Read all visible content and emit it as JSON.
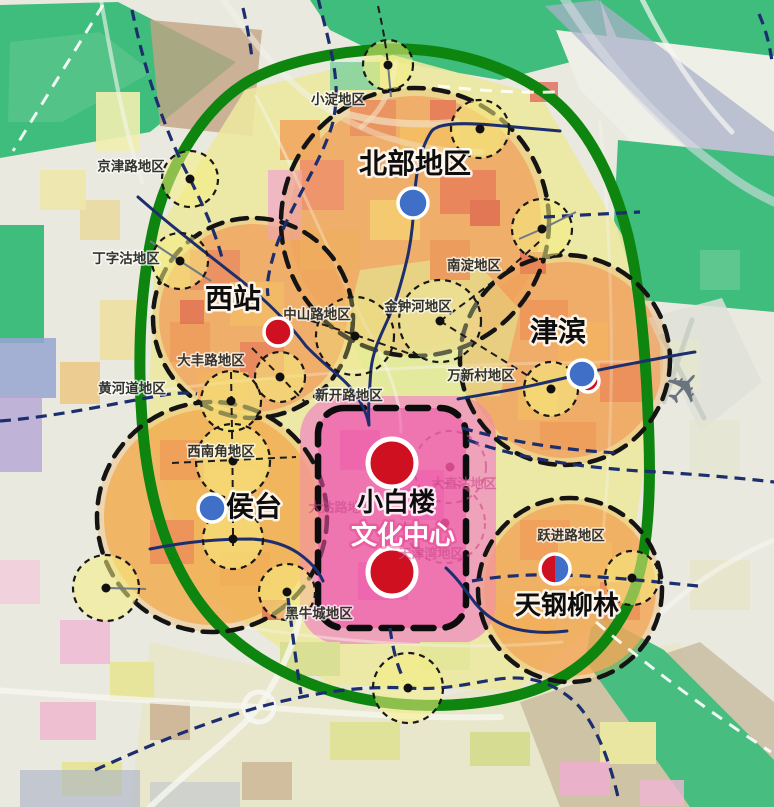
{
  "map": {
    "colors": {
      "ring_green": "#0e850f",
      "corridor_green": "#3fbd7c",
      "navy_line": "#1d2e6e",
      "node_blue": "#3f6fc7",
      "node_red": "#cf1020",
      "center_pink": "#ee55a8",
      "subcenter_yellow": "rgba(246,238,130,0.55)"
    },
    "regions": [
      {
        "id": "beibu",
        "text": "北部地区",
        "x": 415,
        "y": 173,
        "size": 28
      },
      {
        "id": "xizhan",
        "text": "西站",
        "x": 233,
        "y": 308,
        "size": 28
      },
      {
        "id": "jinbin",
        "text": "津滨",
        "x": 558,
        "y": 341,
        "size": 28
      },
      {
        "id": "houtai",
        "text": "侯台",
        "x": 254,
        "y": 516,
        "size": 28
      },
      {
        "id": "xiaobailou",
        "text": "小白楼",
        "x": 396,
        "y": 511,
        "size": 26
      },
      {
        "id": "wenhuazhongxin",
        "text": "文化中心",
        "x": 403,
        "y": 544,
        "size": 26,
        "color": "#ffffff",
        "halo": "rgba(230,60,140,0.45)"
      },
      {
        "id": "tiangangliulin",
        "text": "天钢柳林",
        "x": 567,
        "y": 614,
        "size": 26
      }
    ],
    "areas": [
      {
        "id": "xiaodian",
        "text": "小淀地区",
        "x": 338,
        "y": 104
      },
      {
        "id": "jingjinlu",
        "text": "京津路地区",
        "x": 131,
        "y": 171
      },
      {
        "id": "dingzigu",
        "text": "丁字沽地区",
        "x": 126,
        "y": 263
      },
      {
        "id": "zhongshanlu",
        "text": "中山路地区",
        "x": 317,
        "y": 319
      },
      {
        "id": "jinzhonghe",
        "text": "金钟河地区",
        "x": 418,
        "y": 311
      },
      {
        "id": "nandian",
        "text": "南淀地区",
        "x": 474,
        "y": 270
      },
      {
        "id": "wanxincun",
        "text": "万新村地区",
        "x": 481,
        "y": 380
      },
      {
        "id": "xinkailu",
        "text": "新开路地区",
        "x": 349,
        "y": 400
      },
      {
        "id": "dafenglu",
        "text": "大丰路地区",
        "x": 211,
        "y": 365
      },
      {
        "id": "huanghedao",
        "text": "黄河道地区",
        "x": 132,
        "y": 393
      },
      {
        "id": "xinanjiao",
        "text": "西南角地区",
        "x": 221,
        "y": 456
      },
      {
        "id": "yuejinlu",
        "text": "跃进路地区",
        "x": 571,
        "y": 540
      },
      {
        "id": "heiniucheng",
        "text": "黑牛城地区",
        "x": 319,
        "y": 618
      }
    ],
    "faint_areas": [
      {
        "id": "dagulu",
        "text": "大沽路地区",
        "x": 341,
        "y": 512
      },
      {
        "id": "dazhigu",
        "text": "大直沽地区",
        "x": 464,
        "y": 488
      },
      {
        "id": "tianjinwan",
        "text": "天津湾地区",
        "x": 431,
        "y": 558
      }
    ],
    "districts": [
      {
        "id": "beibu",
        "cx": 415,
        "cy": 222,
        "r": 134,
        "tint": "rgba(240,165,85,0.30)"
      },
      {
        "id": "xizhan",
        "cx": 253,
        "cy": 318,
        "r": 100,
        "tint": "rgba(240,165,85,0.30)"
      },
      {
        "id": "jinbin",
        "cx": 565,
        "cy": 360,
        "r": 105,
        "tint": "rgba(240,160,80,0.32)"
      },
      {
        "id": "houtai",
        "cx": 212,
        "cy": 517,
        "r": 115,
        "tint": "rgba(243,170,75,0.32)"
      },
      {
        "id": "tiangang",
        "cx": 570,
        "cy": 590,
        "r": 92,
        "tint": "rgba(242,168,80,0.32)"
      }
    ],
    "center_district": {
      "id": "xiaobailou-wenhua",
      "x": 318,
      "y": 408,
      "w": 148,
      "h": 220,
      "rx": 26,
      "fill": "rgba(238,80,170,0.55)"
    },
    "subcenters": [
      {
        "cx": 388,
        "cy": 65,
        "r": 25
      },
      {
        "cx": 480,
        "cy": 129,
        "r": 29
      },
      {
        "cx": 190,
        "cy": 179,
        "r": 28
      },
      {
        "cx": 542,
        "cy": 229,
        "r": 30
      },
      {
        "cx": 180,
        "cy": 261,
        "r": 28
      },
      {
        "cx": 355,
        "cy": 336,
        "r": 39,
        "fill": "rgba(246,238,130,0.28)"
      },
      {
        "cx": 440,
        "cy": 321,
        "r": 41,
        "fill": "rgba(240,246,170,0.35)"
      },
      {
        "cx": 551,
        "cy": 389,
        "r": 27
      },
      {
        "cx": 280,
        "cy": 377,
        "r": 25
      },
      {
        "cx": 231,
        "cy": 401,
        "r": 30
      },
      {
        "cx": 233,
        "cy": 461,
        "r": 37
      },
      {
        "cx": 233,
        "cy": 539,
        "r": 30
      },
      {
        "cx": 106,
        "cy": 588,
        "r": 33
      },
      {
        "cx": 287,
        "cy": 592,
        "r": 28
      },
      {
        "cx": 408,
        "cy": 688,
        "r": 35
      },
      {
        "cx": 632,
        "cy": 578,
        "r": 27
      }
    ],
    "faint_subcenters": [
      {
        "cx": 450,
        "cy": 467,
        "r": 36
      },
      {
        "cx": 445,
        "cy": 523,
        "r": 40
      }
    ],
    "nodes": [
      {
        "type": "red",
        "cx": 588,
        "cy": 381,
        "r": 11
      },
      {
        "type": "blue",
        "cx": 413,
        "cy": 203,
        "r": 15
      },
      {
        "type": "blue",
        "cx": 582,
        "cy": 374,
        "r": 14
      },
      {
        "type": "blue",
        "cx": 212,
        "cy": 508,
        "r": 14
      },
      {
        "type": "red",
        "cx": 278,
        "cy": 332,
        "r": 14
      },
      {
        "type": "red",
        "cx": 392,
        "cy": 463,
        "r": 24
      },
      {
        "type": "red",
        "cx": 392,
        "cy": 572,
        "r": 24
      },
      {
        "type": "half",
        "cx": 555,
        "cy": 569,
        "r": 15
      }
    ],
    "icons": [
      {
        "name": "airport-icon",
        "glyph": "✈",
        "x": 684,
        "y": 388,
        "size": 46,
        "color": "#6b7280",
        "rotate": -48
      }
    ]
  }
}
